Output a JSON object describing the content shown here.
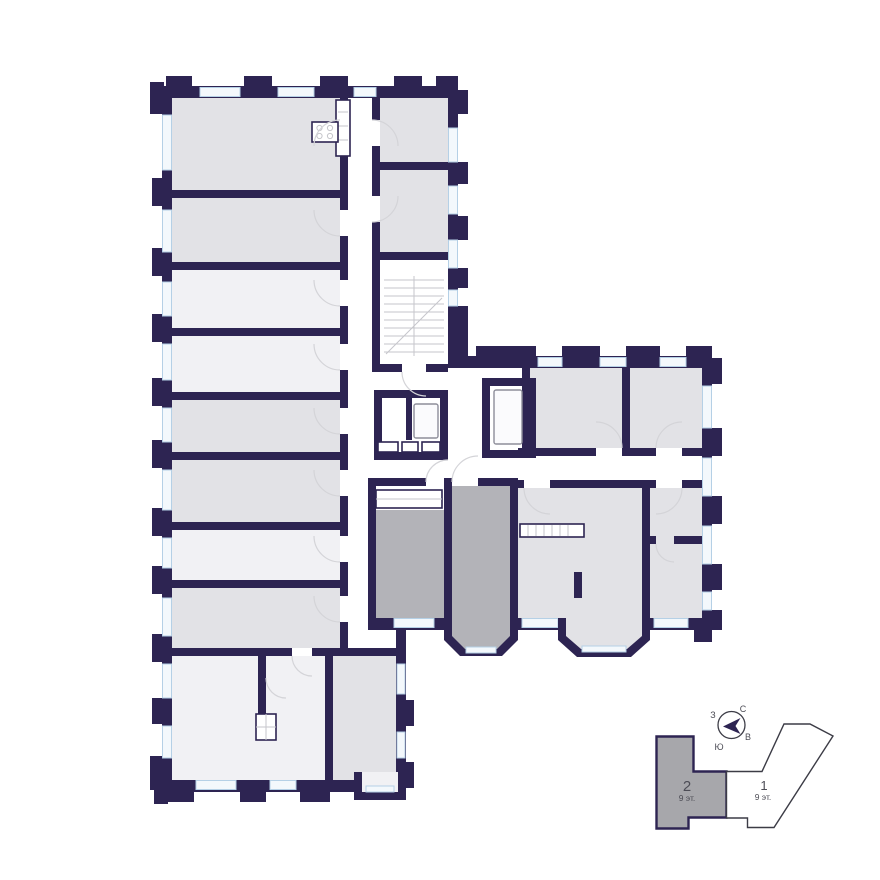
{
  "colors": {
    "wall": "#2d2452",
    "room": "#e2e2e6",
    "room-light": "#f1f1f4",
    "room-selected": "#b3b3b8",
    "window-fill": "#f3f8fc",
    "window-stroke": "#b5d0e6",
    "door-arc": "#d4d4d8",
    "detail": "#c6c6cb",
    "keyplan-fill": "#a7a7ab",
    "keyplan-outline": "#3c3c46",
    "label": "#4d4d56",
    "background": "#ffffff"
  },
  "compass": {
    "north": "С",
    "east": "В",
    "south": "Ю",
    "west": "З"
  },
  "keyplan": {
    "sections": [
      {
        "number": "2",
        "floors": "9 эт.",
        "selected": true
      },
      {
        "number": "1",
        "floors": "9 эт.",
        "selected": false
      }
    ]
  }
}
